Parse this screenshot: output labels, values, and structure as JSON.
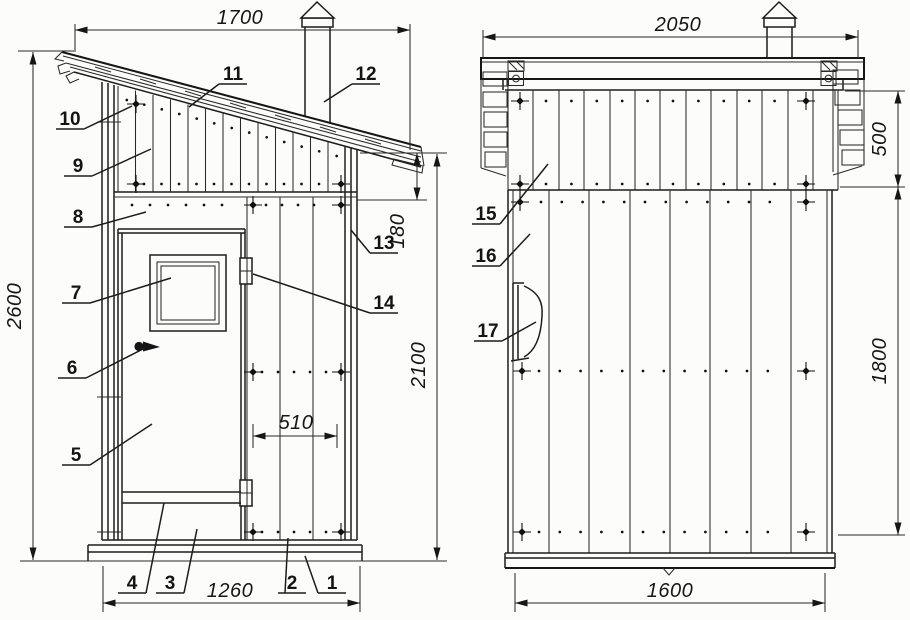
{
  "drawing": {
    "views": {
      "front": {
        "dimensions": {
          "roof_width": "1700",
          "overall_height": "2600",
          "wall_height": "2100",
          "eave_height": "180",
          "opening_width": "510",
          "base_width": "1260"
        },
        "callouts": [
          "1",
          "2",
          "3",
          "4",
          "5",
          "6",
          "7",
          "8",
          "9",
          "10",
          "11",
          "12",
          "13",
          "14"
        ]
      },
      "side": {
        "dimensions": {
          "roof_length": "2050",
          "gable_band_height": "500",
          "wall_height": "1800",
          "base_length": "1600"
        },
        "callouts": [
          "15",
          "16",
          "17"
        ]
      }
    }
  }
}
